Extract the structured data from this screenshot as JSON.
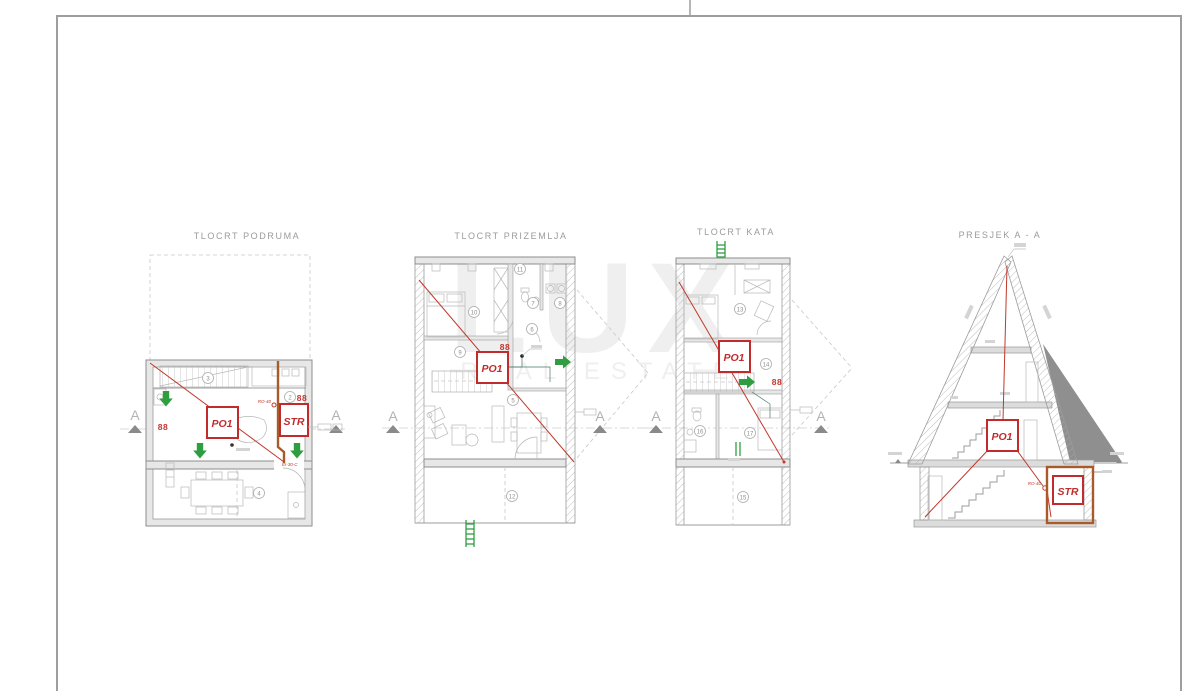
{
  "watermark": {
    "brand": "LUX",
    "tagline": "REAL ESTATE"
  },
  "section_marker": "A",
  "panels": {
    "podrum": {
      "title": "TLOCRT PODRUMA",
      "unit_label": "PO1",
      "storage_label": "STR",
      "duct_label": "RO-40",
      "fire_door_label": "EI-30-C",
      "rooms": {
        "n2": "2",
        "n3": "3",
        "n4": "4"
      },
      "persons_symbol": "88"
    },
    "prizemlje": {
      "title": "TLOCRT PRIZEMLJA",
      "unit_label": "PO1",
      "rooms": {
        "n5": "5",
        "n6": "6",
        "n7": "7",
        "n8": "8",
        "n9": "9",
        "n10": "10",
        "n11": "11",
        "n12": "12"
      },
      "persons_symbol": "88"
    },
    "kat": {
      "title": "TLOCRT KATA",
      "unit_label": "PO1",
      "rooms": {
        "n13": "13",
        "n14": "14",
        "n15": "15",
        "n16": "16",
        "n17": "17"
      },
      "persons_symbol": "88"
    },
    "presjek": {
      "title": "PRESJEK A - A",
      "unit_label": "PO1",
      "storage_label": "STR",
      "duct_label": "RO-40"
    }
  },
  "colors": {
    "accent_red": "#c22b2b",
    "escape_green": "#2f9e41",
    "duct_brown": "#a85a28",
    "line_gray": "#9a9a9a"
  }
}
